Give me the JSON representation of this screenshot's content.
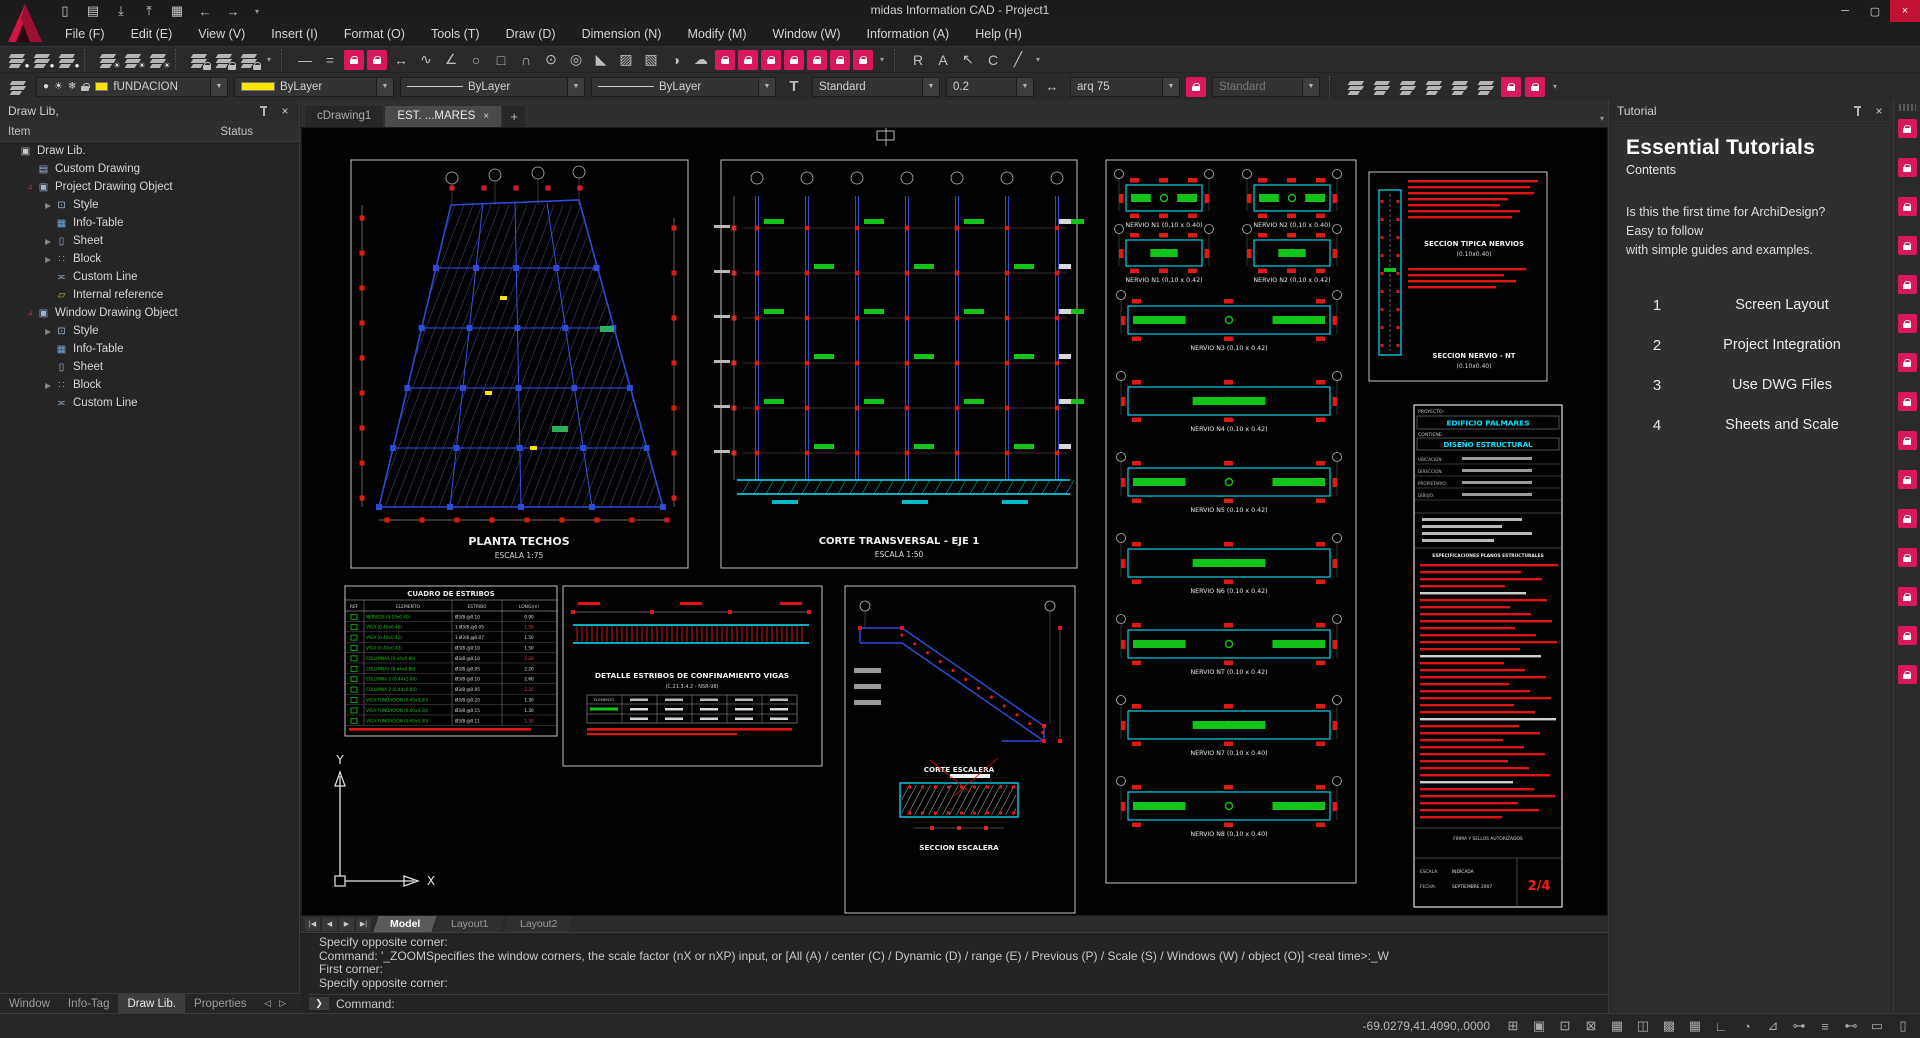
{
  "window": {
    "title": "midas Information CAD - Project1",
    "controls": {
      "minimize": "─",
      "maximize": "▢",
      "close": "×"
    }
  },
  "quick_access": [
    {
      "name": "new-file-icon",
      "glyph": "▯"
    },
    {
      "name": "open-folder-icon",
      "glyph": "▤"
    },
    {
      "name": "save-icon",
      "glyph": "⤓"
    },
    {
      "name": "save-as-icon",
      "glyph": "⤒"
    },
    {
      "name": "export-icon",
      "glyph": "▦"
    },
    {
      "name": "undo-icon",
      "glyph": "←"
    },
    {
      "name": "redo-icon",
      "glyph": "→"
    },
    {
      "name": "quick-access-options-icon",
      "glyph": "▾",
      "small": true
    }
  ],
  "menu": [
    "File (F)",
    "Edit (E)",
    "View (V)",
    "Insert (I)",
    "Format (O)",
    "Tools (T)",
    "Draw (D)",
    "Dimension (N)",
    "Modify (M)",
    "Window (W)",
    "Information (A)",
    "Help (H)"
  ],
  "toolbar": {
    "items": [
      {
        "name": "layer-visibility-icon",
        "type": "sheet",
        "sub": "bulb"
      },
      {
        "name": "layer-visibility-2-icon",
        "type": "sheet",
        "sub": "bulb"
      },
      {
        "name": "layer-visibility-3-icon",
        "type": "sheet",
        "sub": "bulb"
      },
      {
        "name": "sep",
        "type": "sep"
      },
      {
        "name": "layer-freeze-icon",
        "type": "sheet",
        "sub": "sun"
      },
      {
        "name": "layer-freeze-2-icon",
        "type": "sheet",
        "sub": "sun"
      },
      {
        "name": "layer-freeze-3-icon",
        "type": "sheet",
        "sub": "sun"
      },
      {
        "name": "sep",
        "type": "sep"
      },
      {
        "name": "layer-lock-icon",
        "type": "sheet",
        "sub": "lock"
      },
      {
        "name": "layer-lock-2-icon",
        "type": "sheet",
        "sub": "lock"
      },
      {
        "name": "layer-unlock-icon",
        "type": "sheet",
        "sub": "lock"
      },
      {
        "name": "toolbar-more-icon",
        "type": "glyph",
        "glyph": "▾",
        "small": true
      },
      {
        "name": "sep",
        "type": "sep"
      },
      {
        "name": "line-tool-icon",
        "type": "glyph",
        "glyph": "—"
      },
      {
        "name": "double-line-tool-icon",
        "type": "glyph",
        "glyph": "="
      },
      {
        "name": "locked-tool-icon",
        "type": "pink"
      },
      {
        "name": "locked-tool-icon",
        "type": "pink"
      },
      {
        "name": "stretch-tool-icon",
        "type": "glyph",
        "glyph": "↔"
      },
      {
        "name": "spline-tool-icon",
        "type": "glyph",
        "glyph": "∿"
      },
      {
        "name": "angle-tool-icon",
        "type": "glyph",
        "glyph": "∠"
      },
      {
        "name": "ellipse-tool-icon",
        "type": "glyph",
        "glyph": "○"
      },
      {
        "name": "rectangle-tool-icon",
        "type": "glyph",
        "glyph": "□"
      },
      {
        "name": "arc-tool-icon",
        "type": "glyph",
        "glyph": "∩"
      },
      {
        "name": "circle-tool-icon",
        "type": "glyph",
        "glyph": "⊙"
      },
      {
        "name": "donut-tool-icon",
        "type": "glyph",
        "glyph": "◎"
      },
      {
        "name": "wedge-tool-icon",
        "type": "glyph",
        "glyph": "◣"
      },
      {
        "name": "hatch-tool-icon",
        "type": "glyph",
        "glyph": "▨"
      },
      {
        "name": "hatch-2-tool-icon",
        "type": "glyph",
        "glyph": "▧"
      },
      {
        "name": "gradient-tool-icon",
        "type": "glyph",
        "glyph": "◑"
      },
      {
        "name": "revision-cloud-tool-icon",
        "type": "glyph",
        "glyph": "☁"
      },
      {
        "name": "locked-tool-icon",
        "type": "pink"
      },
      {
        "name": "locked-tool-icon",
        "type": "pink"
      },
      {
        "name": "locked-tool-icon",
        "type": "pink"
      },
      {
        "name": "locked-tool-icon",
        "type": "pink"
      },
      {
        "name": "locked-tool-icon",
        "type": "pink"
      },
      {
        "name": "locked-tool-icon",
        "type": "pink"
      },
      {
        "name": "locked-tool-icon",
        "type": "pink"
      },
      {
        "name": "toolbar-more-icon",
        "type": "glyph",
        "glyph": "▾",
        "small": true
      },
      {
        "name": "sep",
        "type": "sep"
      },
      {
        "name": "paste-special-icon",
        "type": "glyph",
        "glyph": "R"
      },
      {
        "name": "text-insert-icon",
        "type": "glyph",
        "glyph": "A"
      },
      {
        "name": "multileader-icon",
        "type": "glyph",
        "glyph": "↖"
      },
      {
        "name": "copy-properties-icon",
        "type": "glyph",
        "glyph": "C"
      },
      {
        "name": "edit-block-icon",
        "type": "glyph",
        "glyph": "╱"
      },
      {
        "name": "toolbar-more-icon",
        "type": "glyph",
        "glyph": "▾",
        "small": true
      }
    ]
  },
  "properties_bar": {
    "layer": "fUNDACION",
    "color": "ByLayer",
    "linetype": "ByLayer",
    "lineweight": "ByLayer",
    "text_style": "Standard",
    "text_size": "0.2",
    "dim_style": "arq 75",
    "table_style": "Standard",
    "right_icons": [
      {
        "name": "layer-states-icon",
        "type": "sheet"
      },
      {
        "name": "layer-translate-icon",
        "type": "sheet"
      },
      {
        "name": "layer-prev-icon",
        "type": "sheet"
      },
      {
        "name": "layer-match-icon",
        "type": "sheet"
      },
      {
        "name": "layer-merge-icon",
        "type": "sheet"
      },
      {
        "name": "layer-delete-icon",
        "type": "sheet"
      },
      {
        "name": "locked-tool-icon",
        "type": "pink"
      },
      {
        "name": "locked-tool-icon",
        "type": "pink"
      },
      {
        "name": "toolbar-more-icon",
        "type": "glyph",
        "glyph": "▾",
        "small": true
      }
    ]
  },
  "draw_lib_panel": {
    "title": "Draw Lib,",
    "columns": [
      "Item",
      "Status"
    ],
    "tree": [
      {
        "label": "Draw Lib.",
        "depth": 0,
        "icon": "drawlib-icon"
      },
      {
        "label": "Custom Drawing",
        "depth": 1,
        "icon": "custom-drawing-icon"
      },
      {
        "label": "Project Drawing Object",
        "depth": 1,
        "icon": "drawing-object-icon",
        "expanded": true
      },
      {
        "label": "Style",
        "depth": 2,
        "icon": "style-icon",
        "collapsible": true
      },
      {
        "label": "Info-Table",
        "depth": 2,
        "icon": "info-table-icon"
      },
      {
        "label": "Sheet",
        "depth": 2,
        "icon": "sheet-icon",
        "collapsible": true
      },
      {
        "label": "Block",
        "depth": 2,
        "icon": "block-icon",
        "collapsible": true
      },
      {
        "label": "Custom Line",
        "depth": 2,
        "icon": "custom-line-icon"
      },
      {
        "label": "Internal reference",
        "depth": 2,
        "icon": "internal-ref-icon"
      },
      {
        "label": "Window Drawing Object",
        "depth": 1,
        "icon": "drawing-object-icon",
        "expanded": true
      },
      {
        "label": "Style",
        "depth": 2,
        "icon": "style-icon",
        "collapsible": true
      },
      {
        "label": "Info-Table",
        "depth": 2,
        "icon": "info-table-icon"
      },
      {
        "label": "Sheet",
        "depth": 2,
        "icon": "sheet-icon"
      },
      {
        "label": "Block",
        "depth": 2,
        "icon": "block-icon",
        "collapsible": true
      },
      {
        "label": "Custom Line",
        "depth": 2,
        "icon": "custom-line-icon"
      }
    ]
  },
  "panel_tabs": {
    "items": [
      "Window",
      "Info-Tag",
      "Draw Lib.",
      "Properties"
    ],
    "active": "Draw Lib.",
    "arrows": [
      "◁",
      "▷"
    ]
  },
  "drawing_tabs": {
    "items": [
      {
        "label": "cDrawing1",
        "active": false
      },
      {
        "label": "EST. ...MARES",
        "active": true,
        "closable": true
      }
    ],
    "close_glyph": "×",
    "add": "+",
    "overflow": "▾"
  },
  "layout_tabs": {
    "nav": [
      "|◀",
      "◀",
      "▶",
      "▶|"
    ],
    "items": [
      "Model",
      "Layout1",
      "Layout2"
    ],
    "active": "Model"
  },
  "command": {
    "lines": [
      "Specify opposite corner:",
      "Command:  '_ZOOMSpecifies the window corners, the scale factor (nX or nXP) input, or [All (A) / center (C) / Dynamic (D) / range (E) / Previous (P) / Scale (S) / Windows (W) / object (O)]  <real time>:_W",
      "First corner:",
      "Specify opposite corner:"
    ],
    "prompt": "Command:",
    "prompt_glyph": "❯"
  },
  "status_bar": {
    "coords": "-69.0279,41.4090,.0000",
    "icons": [
      {
        "name": "pan-icon",
        "glyph": "⊞"
      },
      {
        "name": "pin-alert-icon",
        "glyph": "▣"
      },
      {
        "name": "pin-icon",
        "glyph": "⊡"
      },
      {
        "name": "view-box-icon",
        "glyph": "⊠"
      },
      {
        "name": "block-select-icon",
        "glyph": "▦"
      },
      {
        "name": "selection-lock-icon",
        "glyph": "◫"
      },
      {
        "name": "grid-icon",
        "glyph": "▩"
      },
      {
        "name": "snap-grid-icon",
        "glyph": "▦"
      },
      {
        "name": "ortho-icon",
        "glyph": "∟"
      },
      {
        "name": "polar-icon",
        "glyph": "◔"
      },
      {
        "name": "osnap-icon",
        "glyph": "⊿"
      },
      {
        "name": "otrack-icon",
        "glyph": "⊶"
      },
      {
        "name": "lineweight-icon",
        "glyph": "≡"
      },
      {
        "name": "dyn-dim-icon",
        "glyph": "⊷"
      },
      {
        "name": "clean-screen-icon",
        "glyph": "▭"
      },
      {
        "name": "ui-lock-icon",
        "glyph": "▯"
      }
    ]
  },
  "tutorial": {
    "title": "Tutorial",
    "heading": "Essential Tutorials",
    "subheading": "Contents",
    "intro_lines": [
      "Is this the first time for ArchiDesign?",
      "Easy to follow",
      "with simple guides and examples."
    ],
    "items": [
      {
        "num": "1",
        "label": "Screen Layout"
      },
      {
        "num": "2",
        "label": "Project Integration"
      },
      {
        "num": "3",
        "label": "Use DWG Files"
      },
      {
        "num": "4",
        "label": "Sheets and Scale"
      }
    ]
  },
  "side_strip": {
    "lock_count": 15
  },
  "canvas": {
    "plan": {
      "title": "PLANTA TECHOS",
      "scale": "ESCALA 1:75"
    },
    "section": {
      "title": "CORTE TRANSVERSAL - EJE 1",
      "scale": "ESCALA 1:50"
    },
    "stair": {
      "title": "CORTE ESCALERA",
      "title2": "SECCION ESCALERA"
    },
    "typical": {
      "title": "SECCION TIPICA NERVIOS",
      "dim": "(0.10x0.40)",
      "title2": "SECCION NERVIO - NT",
      "dim2": "(0.10x0.40)"
    },
    "beam_detail": {
      "title": "DETALLE ESTRIBOS DE CONFINAMIENTO VIGAS",
      "subtitle": "(C.21.3.4.2 - NSR-98)"
    },
    "nervios_pairs": [
      "NERVIO N1 (0.10 x 0.40)",
      "NERVIO N2 (0.10 x 0.40)",
      "NERVIO N1 (0.10 x 0.42)",
      "NERVIO N2 (0.10 x 0.42)"
    ],
    "nervios_full": [
      "NERVIO N3 (0.10 x 0.42)",
      "NERVIO N4 (0.10 x 0.42)",
      "NERVIO N5 (0.10 x 0.42)",
      "NERVIO N6 (0.10 x 0.42)",
      "NERVIO NT (0.10 x 0.42)",
      "NERVIO N7 (0.10 x 0.40)",
      "NERVIO N8 (0.10 x 0.40)"
    ],
    "stirrup_table": {
      "title": "CUADRO DE ESTRIBOS",
      "headers": [
        "REF",
        "ELEMENTO",
        "ESTRIBO",
        "LONG(m)"
      ],
      "rows": [
        {
          "el": "NERVIOS (0.10x0.40)",
          "est": "Ø3/8 @0.10",
          "len": "0.90"
        },
        {
          "el": "VIGA (0.40x0.40)",
          "est": "1 Ø3/8 @0.05",
          "len": "1.50"
        },
        {
          "el": "VIGA (0.40x0.42)",
          "est": "1 Ø3/8 @0.07",
          "len": "1.50"
        },
        {
          "el": "VIGA (0.40x0.42)",
          "est": "Ø3/8 @0.10",
          "len": "1.50"
        },
        {
          "el": "COLUMNAS (0.44x0.86)",
          "est": "Ø3/8 @0.10",
          "len": "2.20"
        },
        {
          "el": "COLUMNAS (0.44x0.86)",
          "est": "Ø3/8 @0.05",
          "len": "2.20"
        },
        {
          "el": "COLUMNA 2 (0.44x1.06)",
          "est": "Ø3/8 @0.10",
          "len": "2.60"
        },
        {
          "el": "COLUMNA 2 (0.44x0.86)",
          "est": "Ø3/8 @0.05",
          "len": "2.20"
        },
        {
          "el": "VIGA FUNDACION (0.40x0.30)",
          "est": "Ø3/8 @0.20",
          "len": "1.30"
        },
        {
          "el": "VIGA FUNDACION (0.40x0.30)",
          "est": "Ø3/8 @0.15",
          "len": "1.30"
        },
        {
          "el": "VIGA FUNDACION (0.40x0.30)",
          "est": "Ø3/8 @0.11",
          "len": "1.30"
        }
      ]
    },
    "title_block": {
      "project_label": "PROYECTO:",
      "project": "EDIFICIO PALMARES",
      "contains_label": "CONTIENE:",
      "contains": "DISEÑO ESTRUCTURAL",
      "fields": [
        "UBICACION:",
        "DIRECCION:",
        "PROPIETARIO:",
        "DIBUJO:"
      ],
      "spec_header": "ESPECIFICACIONES PLANOS ESTRUCTURALES",
      "firma": "FIRMA Y SELLOS AUTORIZADOS",
      "scale_label": "ESCALA:",
      "scale_value": "INDICADA",
      "date_label": "FECHA:",
      "date_value": "SEPTIEMBRE 2007",
      "page": "2/4"
    },
    "axis": {
      "x": "X",
      "y": "Y"
    }
  },
  "colors": {
    "accent": "#d8175d",
    "yellow": "#ffe400",
    "cyan": "#00e5ff",
    "blue": "#2f4bd6",
    "green": "#12c418",
    "red": "#e01818"
  }
}
